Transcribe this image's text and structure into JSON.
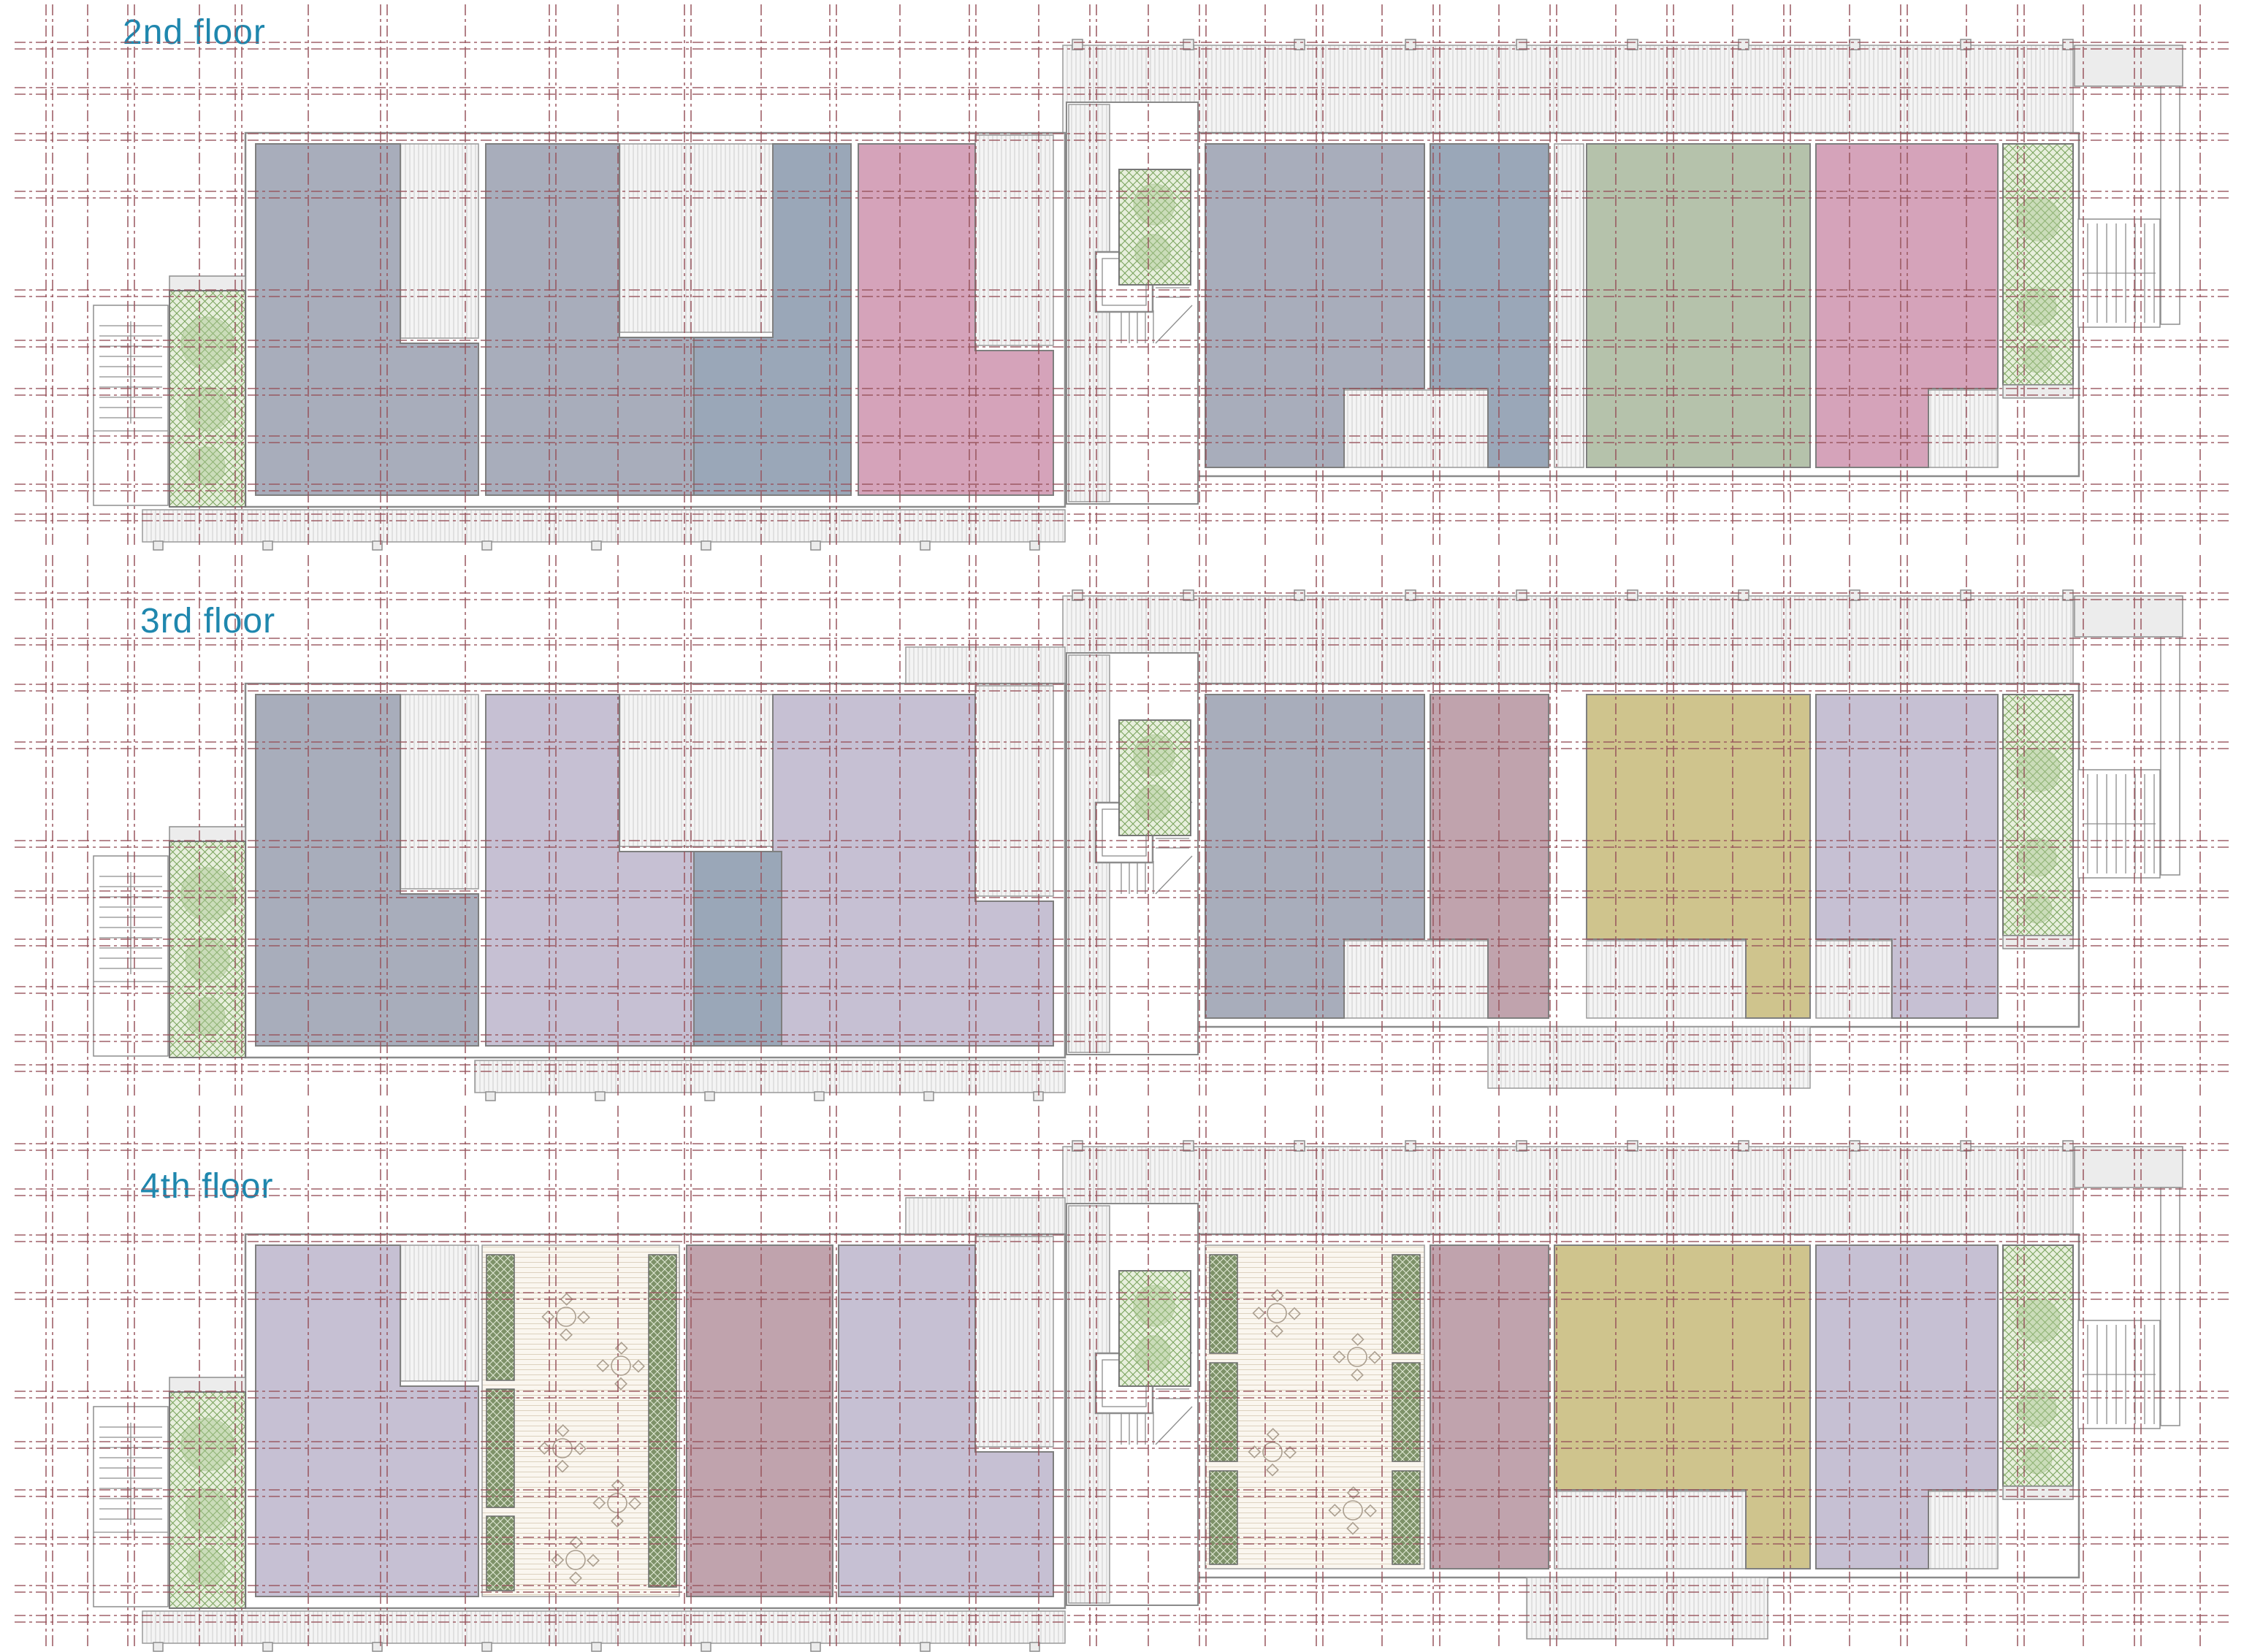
{
  "floors": [
    {
      "id": "2nd-floor",
      "label": "2nd floor",
      "left_wing_rooms": [
        "gray",
        "gray",
        "slate",
        "pink"
      ],
      "right_wing_rooms": [
        "gray",
        "slate",
        "green",
        "pink"
      ],
      "features": [
        "left-exterior-stair",
        "left-planter",
        "core-stair-elevator",
        "core-planter",
        "top-walkway",
        "bottom-deck",
        "right-planter",
        "right-exterior-stair"
      ]
    },
    {
      "id": "3rd-floor",
      "label": "3rd floor",
      "left_wing_rooms": [
        "gray",
        "lavender",
        "slate",
        "lavender"
      ],
      "right_wing_rooms": [
        "gray",
        "rose",
        "olive",
        "lavender"
      ],
      "features": [
        "left-exterior-stair",
        "left-planter",
        "core-stair-elevator",
        "core-planter",
        "top-walkway",
        "bottom-deck",
        "right-planter",
        "right-exterior-stair"
      ]
    },
    {
      "id": "4th-floor",
      "label": "4th floor",
      "left_wing_rooms": [
        "lavender",
        "roof-terrace",
        "rose",
        "lavender"
      ],
      "right_wing_rooms": [
        "roof-terrace",
        "rose",
        "olive",
        "lavender"
      ],
      "features": [
        "left-exterior-stair",
        "left-planter",
        "core-stair-elevator",
        "core-planter",
        "top-walkway",
        "bottom-deck",
        "terrace-planter-strips",
        "terrace-furniture",
        "right-planter",
        "right-exterior-stair"
      ]
    }
  ],
  "palette": {
    "floor_label": "#1f87ae",
    "grid_line": "#97535b",
    "wall_line": "#8d8d8d",
    "room_gray": "#a8adbb",
    "room_slate": "#9aa7b8",
    "room_pink": "#d5a3ba",
    "room_green": "#b5c2ab",
    "room_lavender": "#c6c0d3",
    "room_rose": "#c0a3ad",
    "room_olive": "#cfc48d",
    "planter_light": "#e7efdc",
    "planter_dark": "#7d9168",
    "deck_hatch": "#c7c7c7",
    "terrace_hatch": "#d9cdb9"
  }
}
